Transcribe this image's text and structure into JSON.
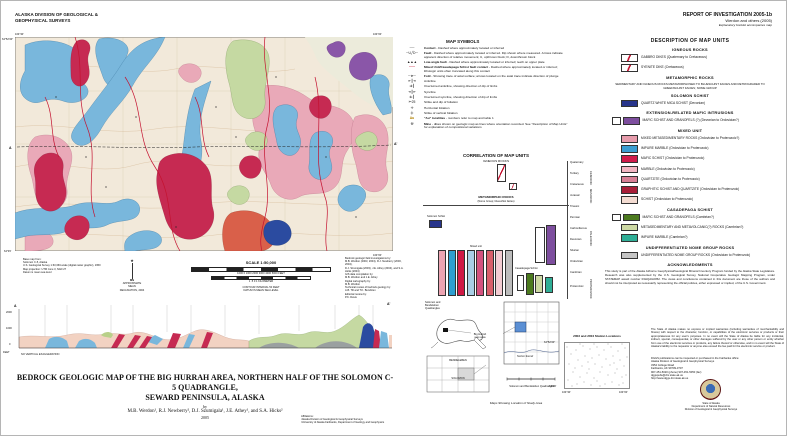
{
  "header": {
    "org": "ALASKA DIVISION OF GEOLOGICAL &\nGEOPHYSICAL SURVEYS",
    "report_no": "REPORT OF INVESTIGATION 2005-1b",
    "report_authors": "Werdon and others (2005)",
    "report_note": "Explanatory booklet accompanies map"
  },
  "map": {
    "coord_nw_lon": "164°30'",
    "coord_ne_lon": "164°00'",
    "coord_nw_lat": "64°52'30\"",
    "coord_sw_lat": "64°45'",
    "coord_se_lon": "164°00'",
    "section_label_a": "A",
    "section_label_a_prime": "A'",
    "base_credits": "Base map from:\nSolomon C-5, Alaska\nU.S. Geological Survey 1:63,360-scale (digital raster graphic), 1950\nMap projection: UTM zone 3, NAD 27\nDatum is mean sea level",
    "north_label": "MN",
    "declination_note": "APPROXIMATE MEAN\nDECLINATION, 2004",
    "scale_label": "SCALE 1:50,000",
    "scalebar_feet": "1000    0    1000    2000    3000    4000    5000 FEET",
    "scalebar_km": "1      .5      0            1 KILOMETER",
    "contour_note": "CONTOUR INTERVAL 50 FEET\nDATUM IS MEAN SEA LEVEL",
    "production_credits": "Bedrock geologic field investigations by:\nM.B. Werdon (2003, 2004), R.J. Newberry (2003, 2004),\nD.J. Szumigala (2003), J.E. Athey (2004), and S.A. Hicks (2004)\nGIS data compilation by:\nM.B. Werdon and J.E. Athey\nDigital cartography by:\nM.B. Werdon\nTechnical review of bedrock geology by:\nA.B. Till and T.K. Bundtzen\nEditorial review by:\nP.K. Davis"
  },
  "cross_section": {
    "label_a": "A",
    "label_a_prime": "A'",
    "elev_top": "2000",
    "elev_mid": "1000",
    "elev_zero": "0",
    "elev_unit": "FEET",
    "note": "NO VERTICAL EXAGGERATION"
  },
  "map_symbols": {
    "title": "MAP SYMBOLS",
    "items": [
      {
        "icon": "contact-line-icon",
        "b": "Contact",
        "t": "- Dashed where approximately located or inferred"
      },
      {
        "icon": "fault-line-icon",
        "b": "Fault",
        "t": "- Dashed where approximately located or inferred. Dip shown where measured. Arrows indicate apparent direction of relative movement; U, upthrown block; D, downthrown block"
      },
      {
        "icon": "low-angle-fault-icon",
        "b": "Low-angle fault",
        "t": "- Dashed where approximately located or inferred; teeth on upper plate"
      },
      {
        "icon": "mixed-contact-icon",
        "b": "Mixed Unit/Casadepaga Schist fault contact",
        "t": "- Dashed where approximately located or inferred; lithologic units often truncated along this contact"
      },
      {
        "icon": "fold-axis-icon",
        "b": "Fold",
        "t": "- Showing trace of axial surface; arrows located on the axial trace indicate direction of plunge"
      },
      {
        "icon": "anticline-icon",
        "b": "",
        "t": "Anticline"
      },
      {
        "icon": "overturned-anticline-icon",
        "b": "",
        "t": "Overturned anticline, showing direction of dip of limbs"
      },
      {
        "icon": "syncline-icon",
        "b": "",
        "t": "Syncline"
      },
      {
        "icon": "overturned-syncline-icon",
        "b": "",
        "t": "Overturned syncline, showing direction of dip of limbs"
      },
      {
        "icon": "strike-dip-icon",
        "b": "",
        "t": "Strike and dip of foliation"
      },
      {
        "icon": "horizontal-foliation-icon",
        "b": "",
        "t": "Horizontal foliation"
      },
      {
        "icon": "vertical-foliation-icon",
        "b": "",
        "t": "Strike of vertical foliation"
      },
      {
        "icon": "gold-locality-icon",
        "b": "\"Au\" localities",
        "t": "- numbers refer to map and table 1"
      },
      {
        "icon": "mine-icon",
        "b": "Mine",
        "t": "- dikes shown on geologic map as lines where orientation recorded. See \"Description of Map Units\" for explanation of compositional variations"
      }
    ]
  },
  "correlation": {
    "title": "CORRELATION OF MAP UNITS",
    "igneous_header": "IGNEOUS ROCKS",
    "metamorphic_header": "METAMORPHIC ROCKS",
    "metamorphic_sub": "(Nome Group; blueschist facies)",
    "solomon_label": "Solomon Schist",
    "mixed_label": "Mixed unit",
    "casadepaga_label": "Casadepaga Schist",
    "solomon_color": "#27348b",
    "purple_color": "#7d4e9e",
    "mixed_colors": [
      "#eda4b2",
      "#2e9fd0",
      "#d01945",
      "#a9cfe6",
      "#d4537f",
      "#d95f6a",
      "#f3ccd2",
      "#bcbcbc"
    ],
    "casadepaga_colors": [
      "#4c7a1f",
      "#cdd9a3",
      "#2fae96"
    ],
    "time_labels": [
      "Quaternary",
      "Tertiary",
      "Cretaceous",
      "Jurassic",
      "Triassic",
      "Permian",
      "Carboniferous",
      "Devonian",
      "Silurian",
      "Ordovician",
      "Cambrian",
      "Proterozoic"
    ],
    "era_labels": [
      "CENOZOIC",
      "MESOZOIC",
      "PALEOZOIC",
      "PROTEROZOIC"
    ]
  },
  "description": {
    "title": "DESCRIPTION OF MAP UNITS",
    "igneous_header": "IGNEOUS ROCKS",
    "units_igneous": [
      {
        "color": "#ffffff",
        "label": "GABBRO DIKES (Quaternary to Cretaceous)"
      },
      {
        "color": "#ffffff",
        "label": "SYENITE DIKE (Cretaceous)"
      }
    ],
    "metamorphic_header": "METAMORPHIC ROCKS",
    "metamorphic_note": "SEDIMENTARY AND IGNEOUS ROCKS METAMORPHOSED TO BLUESCHIST FACIES AND RETROGRADED TO GREENSCHIST FACIES; NOME GROUP",
    "solomon_header": "SOLOMON SCHIST",
    "solomon_units": [
      {
        "color": "#27348b",
        "label": "QUARTZ WHITE MICA SCHIST (Devonian)"
      }
    ],
    "extension_header": "EXTENSION-RELATED MAFIC INTRUSIONS",
    "extension_units": [
      {
        "color": "#7d4e9e",
        "label": "MAFIC SCHIST AND GRANOFELS (?) (Devonian to Ordovician?)"
      }
    ],
    "mixed_header": "MIXED UNIT",
    "mixed_units": [
      {
        "color": "#e79cac",
        "label": "MIXED METASEDIMENTARY ROCKS (Ordovician to Proterozoic?)"
      },
      {
        "color": "#3b9ed1",
        "label": "IMPURE MARBLE (Ordovician to Proterozoic)"
      },
      {
        "color": "#cf1c4b",
        "label": "MAFIC SCHIST (Ordovician to Proterozoic)"
      },
      {
        "color": "#f2b6c2",
        "label": "MARBLE (Ordovician to Proterozoic)"
      },
      {
        "color": "#d77f95",
        "label": "QUARTZITE (Ordovician to Proterozoic)"
      },
      {
        "color": "#a81e38",
        "label": "GRAPHITIC SCHIST AND QUARTZITE (Ordovician to Proterozoic)"
      },
      {
        "color": "#f4dcd2",
        "label": "SCHIST (Ordovician to Proterozoic)"
      }
    ],
    "casadepaga_header": "CASADEPAGA SCHIST",
    "casadepaga_units": [
      {
        "color": "#4c7a1f",
        "label": "MAFIC SCHIST AND GRANOFELS (Cambrian?)"
      },
      {
        "color": "#cdd9a3",
        "label": "METASEDIMENTARY AND METAVOLCANIC(?) ROCKS (Cambrian?)"
      },
      {
        "color": "#2fae96",
        "label": "IMPURE MARBLE (Cambrian?)"
      }
    ],
    "undiff_header": "UNDIFFERENTIATED NOME GROUP ROCKS",
    "undiff_units": [
      {
        "color": "#c4c4c4",
        "label": "UNDIFFERENTIATED NOME GROUP ROCKS (Ordovician to Proterozoic)"
      }
    ],
    "acknowledgments_title": "ACKNOWLEDGMENTS",
    "acknowledgments_text": "This study is part of the Alaska Airborne Geophysical/Geological Mineral Inventory Program funded by the Alaska State Legislature. Research was also supplemented by the U.S. Geological Survey, National Cooperative Geologic Mapping Program, under STATEMAP award number 03HQAG0052. The views and conclusions contained in this document are those of the authors and should not be interpreted as necessarily representing the official policies, either expressed or implied, of the U.S. Government."
  },
  "location_maps": {
    "alaska_label": "Solomon and\nBendeleben\nQuadrangles",
    "inset_label_top": "BENDELEBEN",
    "inset_label_bottom": "SOLOMON",
    "area_label": "Big Hurrah\nmap area",
    "sound_label": "Norton Sound",
    "quad_caption": "Solomon and Bendeleben Quadrangles",
    "study_caption": "Maps Showing Location of Study Area"
  },
  "station_map": {
    "title": "2003 and 2004 Station Locations",
    "corner_nw_lat": "64°52'30\"",
    "corner_sw_lat": "64°45'",
    "corner_sw_lon": "164°30'",
    "corner_se_lon": "164°00'"
  },
  "footer": {
    "disclaimer": "The State of Alaska makes no express or implied warranties (including warranties of merchantability and fitness) with respect to the character, function, or capabilities of the electronic services or products or their appropriateness for any user's purposes. In no event will the State of Alaska be liable for any incidental, indirect, special, consequential, or other damages suffered by the user or any other person or entity whether from use of the electronic services or products, any failure thereof or otherwise, and in no event will the State of Alaska's liability to the requestor or anyone else exceed the fee paid for the electronic service or product.",
    "ordering": "DGGS publications can be inspected or purchased in the Fairbanks office:\nAlaska Division of Geological & Geophysical Surveys\n3354 College Road\nFairbanks, AK 99709-3707\n907-451-5020 (phone)   907-451-5050 (fax)\ndggspubs@dnr.state.ak.us\nhttp://www.dggs.dnr.state.ak.us",
    "agency": "State of Alaska\nDepartment of Natural Resources\nDivision of Geological & Geophysical Surveys"
  },
  "title_block": {
    "title_line1": "BEDROCK GEOLOGIC MAP OF THE BIG HURRAH AREA, NORTHERN HALF OF THE SOLOMON C-5 QUADRANGLE,",
    "title_line2": "SEWARD PENINSULA, ALASKA",
    "by": "by",
    "authors": "M.B. Werdon¹, R.J. Newberry², D.J. Szumigala¹, J.E. Athey¹, and S.A. Hicks²",
    "year": "2005",
    "affiliations": "Affiliations:\n¹Alaska Division of Geological & Geophysical Surveys\n²University of Alaska Fairbanks, Department of Geology and Geophysics"
  },
  "palette": {
    "map_background": "#f2e9da",
    "fault_red": "#c41230",
    "red_orange_unit": "#d9604a",
    "navy_unit": "#2b4ba0"
  }
}
